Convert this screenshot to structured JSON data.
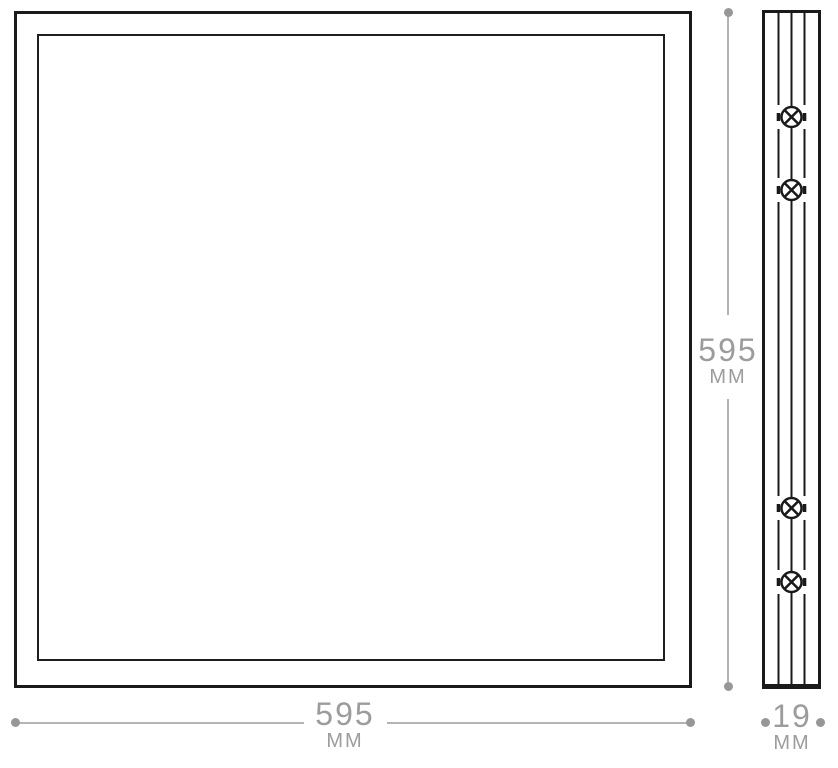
{
  "dimensions": {
    "width": {
      "value": "595",
      "unit": "MM"
    },
    "height": {
      "value": "595",
      "unit": "MM"
    },
    "depth": {
      "value": "19",
      "unit": "MM"
    }
  },
  "side_view": {
    "screw_count": 4
  },
  "icons": {
    "screw": "screw-head-icon"
  },
  "colors": {
    "outline_black": "#1a1a1a",
    "dimension_line_gray": "#b4b4b4",
    "dimension_dot_gray": "#979797",
    "dimension_text_gray": "#9c9c9c",
    "background": "#ffffff"
  }
}
